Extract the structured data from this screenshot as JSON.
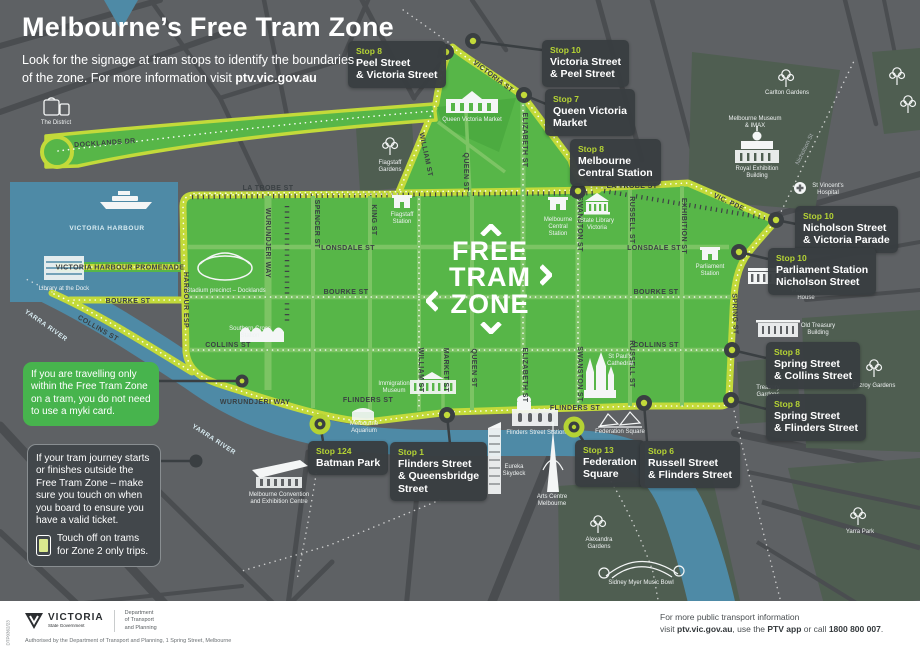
{
  "colors": {
    "zone_green": "#57b648",
    "zone_border": "#c3da3a",
    "callout_bg": "#3b4043",
    "stop_label_green": "#b5d334",
    "water_blue": "#4e8aa6",
    "map_gray": "#5e6164",
    "info_green": "#47b44d",
    "footer_bg": "#ffffff"
  },
  "header": {
    "title": "Melbourne’s Free Tram Zone",
    "subtitle_line1": "Look for the signage at tram stops to identify the boundaries",
    "subtitle_line2": "of the zone. For more information visit",
    "subtitle_link": "ptv.vic.gov.au"
  },
  "zone_logo": {
    "line1": "FREE",
    "line2": "TRAM",
    "line3": "ZONE"
  },
  "stops": [
    {
      "stop": "Stop 8",
      "line1": "Peel Street",
      "line2": "& Victoria Street"
    },
    {
      "stop": "Stop 10",
      "line1": "Victoria Street",
      "line2": "& Peel Street"
    },
    {
      "stop": "Stop 7",
      "line1": "Queen Victoria",
      "line2": "Market"
    },
    {
      "stop": "Stop 8",
      "line1": "Melbourne",
      "line2": "Central Station"
    },
    {
      "stop": "Stop 10",
      "line1": "Nicholson Street",
      "line2": "& Victoria Parade"
    },
    {
      "stop": "Stop 10",
      "line1": "Parliament Station",
      "line2": "Nicholson Street"
    },
    {
      "stop": "Stop 8",
      "line1": "Spring Street",
      "line2": "& Collins Street"
    },
    {
      "stop": "Stop 8",
      "line1": "Spring Street",
      "line2": "& Flinders Street"
    },
    {
      "stop": "Stop 124",
      "line1": "Batman Park"
    },
    {
      "stop": "Stop 1",
      "line1": "Flinders Street",
      "line2": "& Queensbridge",
      "line3": "Street"
    },
    {
      "stop": "Stop 13",
      "line1": "Federation",
      "line2": "Square"
    },
    {
      "stop": "Stop 6",
      "line1": "Russell Street",
      "line2": "& Flinders Street"
    }
  ],
  "info_boxes": {
    "travelling": "If you are travelling only within the Free Tram Zone on a tram, you do not need to use a myki card.",
    "journey": "If your tram journey starts or finishes outside the Free Tram Zone – make sure you touch on when you board to ensure you have a valid ticket.",
    "touch_off": "Touch off on trams for Zone 2 only trips."
  },
  "streets": {
    "docklands_dr": "DOCKLANDS DR",
    "harbour_esp": "HARBOUR ESP",
    "victoria_harbour": "VICTORIA HARBOUR",
    "promenade": "VICTORIA HARBOUR PROMENADE",
    "bourke_w": "BOURKE ST",
    "collins_diag": "COLLINS ST",
    "la_trobe_w": "LA TROBE ST",
    "la_trobe_e": "LA TROBE ST",
    "vic_pde": "VIC. PDE",
    "victoria_st": "VICTORIA ST",
    "elizabeth_n": "ELIZABETH ST",
    "william_n": "WILLIAM ST",
    "wurundjeri_v": "WURUNDJERI WAY",
    "spencer": "SPENCER ST",
    "king": "KING ST",
    "william_s": "WILLIAM ST",
    "market": "MARKET ST",
    "queen_n": "QUEEN ST",
    "queen_s": "QUEEN ST",
    "elizabeth_s": "ELIZABETH ST",
    "swanston_n": "SWANSTON ST",
    "swanston_s": "SWANSTON ST",
    "russell_n": "RUSSELL ST",
    "russell_s": "RUSSELL ST",
    "exhibition": "EXHIBITION ST",
    "spring": "SPRING ST",
    "lonsdale_w": "LONSDALE ST",
    "lonsdale_e": "LONSDALE ST",
    "bourke_c": "BOURKE ST",
    "bourke_e": "BOURKE ST",
    "collins_w": "COLLINS ST",
    "collins_e": "COLLINS ST",
    "flinders_w": "FLINDERS ST",
    "flinders_e": "FLINDERS ST",
    "wurundjeri_h": "WURUNDJERI WAY",
    "yarra_1": "YARRA RIVER",
    "yarra_2": "YARRA RIVER",
    "nicholson": "Nicholson St"
  },
  "pois": {
    "district": "The District",
    "library_dock": "Library at the Dock",
    "stadium": "Stadium precinct – Docklands",
    "southern_cross_1": "Southern Cross",
    "southern_cross_2": "Station",
    "flagstaff_g_1": "Flagstaff",
    "flagstaff_g_2": "Gardens",
    "flagstaff_s_1": "Flagstaff",
    "flagstaff_s_2": "Station",
    "qvm": "Queen Victoria Market",
    "melb_central_1": "Melbourne",
    "melb_central_2": "Central",
    "melb_central_3": "Station",
    "state_library_1": "State Library",
    "state_library_2": "Victoria",
    "parl_station_1": "Parliament",
    "parl_station_2": "Station",
    "parl_house_1": "Parliament",
    "parl_house_2": "House",
    "old_treasury_1": "Old Treasury",
    "old_treasury_2": "Building",
    "treasury_g_1": "Treasury",
    "treasury_g_2": "Gardens",
    "fitzroy": "Fitzroy Gardens",
    "carlton": "Carlton Gardens",
    "museum_1": "Melbourne Museum",
    "museum_2": "& IMAX",
    "reb_1": "Royal Exhibition",
    "reb_2": "Building",
    "stv_1": "St Vincent's",
    "stv_2": "Hospital",
    "immigration_1": "Immigration",
    "immigration_2": "Museum",
    "st_pauls_1": "St Paul's",
    "st_pauls_2": "Cathedral",
    "flinders_station": "Flinders Street Station",
    "fed_square": "Federation Square",
    "aquarium_1": "Melbourne",
    "aquarium_2": "Aquarium",
    "eureka_1": "Eureka",
    "eureka_2": "Skydeck",
    "arts_1": "Arts Centre",
    "arts_2": "Melbourne",
    "mcec_1": "Melbourne Convention",
    "mcec_2": "and Exhibition Centre",
    "alexandra_1": "Alexandra",
    "alexandra_2": "Gardens",
    "music_bowl": "Sidney Myer Music Bowl",
    "yarra_park": "Yarra Park"
  },
  "footer": {
    "code": "DTP0362/23",
    "brand": "VICTORIA",
    "brand_sub": "State Government",
    "dept1": "Department",
    "dept2": "of Transport",
    "dept3": "and Planning",
    "authorised": "Authorised by the Department of Transport and Planning, 1 Spring Street, Melbourne",
    "info1": "For more public transport information",
    "info2_pre": "visit ",
    "info2_b1": "ptv.vic.gov.au",
    "info2_m1": ", use the ",
    "info2_b2": "PTV app",
    "info2_m2": " or call ",
    "info2_b3": "1800 800 007",
    "info2_end": "."
  }
}
